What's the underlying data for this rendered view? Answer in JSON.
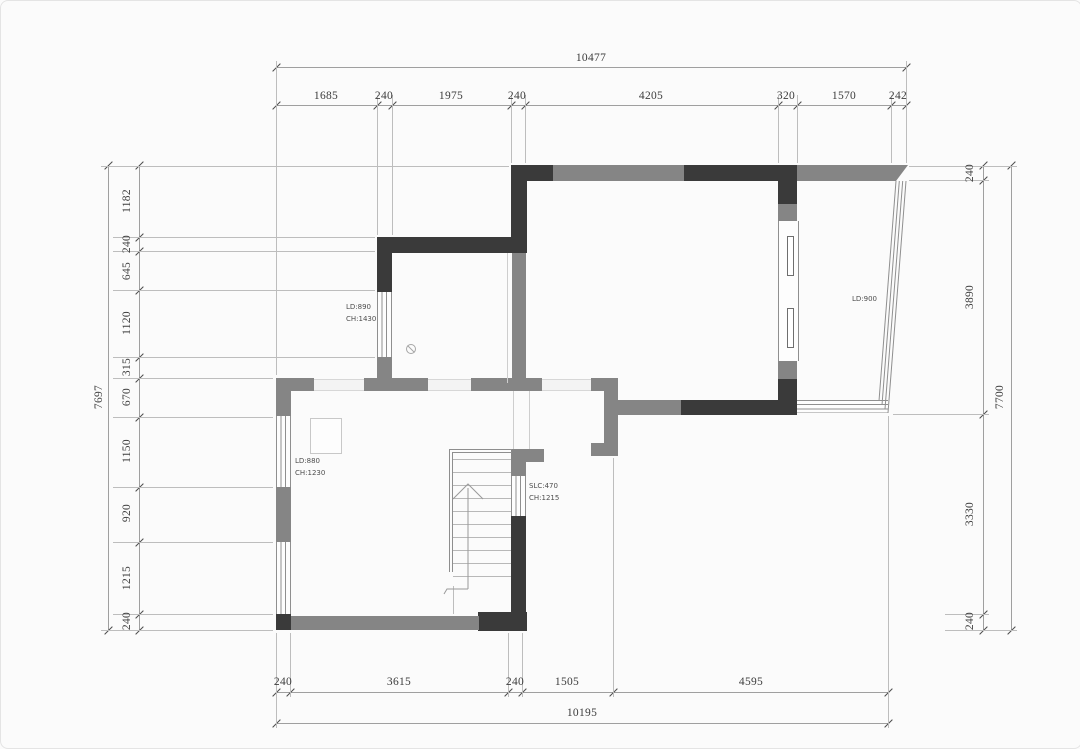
{
  "drawing": {
    "type": "floor-plan",
    "colors": {
      "wall_dark": "#3a3a3a",
      "wall_gray": "#858585",
      "glazing_line": "#8f8f8f",
      "dim_line": "#9f9f9f",
      "dim_text": "#3c3c3c",
      "annotation_text": "#4d4d4d",
      "background": "#fbfbfb"
    }
  },
  "dims": {
    "top": {
      "total": "10477",
      "segments": [
        "1685",
        "240",
        "1975",
        "240",
        "4205",
        "320",
        "1570",
        "242"
      ]
    },
    "bottom": {
      "total": "10195",
      "segments": [
        "240",
        "3615",
        "240",
        "1505",
        "4595"
      ]
    },
    "left": {
      "total": "7697",
      "segments": [
        "1182",
        "240",
        "645",
        "1120",
        "315",
        "670",
        "1150",
        "920",
        "1215",
        "240"
      ]
    },
    "right": {
      "total": "7700",
      "segments": [
        "240",
        "3890",
        "3330",
        "240"
      ]
    }
  },
  "annotations": {
    "upper_window": {
      "lines": [
        "LD:890",
        "CH:1430"
      ]
    },
    "lower_window": {
      "lines": [
        "LD:880",
        "CH:1230"
      ]
    },
    "stair_window": {
      "lines": [
        "SLC:470",
        "CH:1215"
      ]
    },
    "balcony": {
      "lines": [
        "LD:900"
      ]
    }
  }
}
